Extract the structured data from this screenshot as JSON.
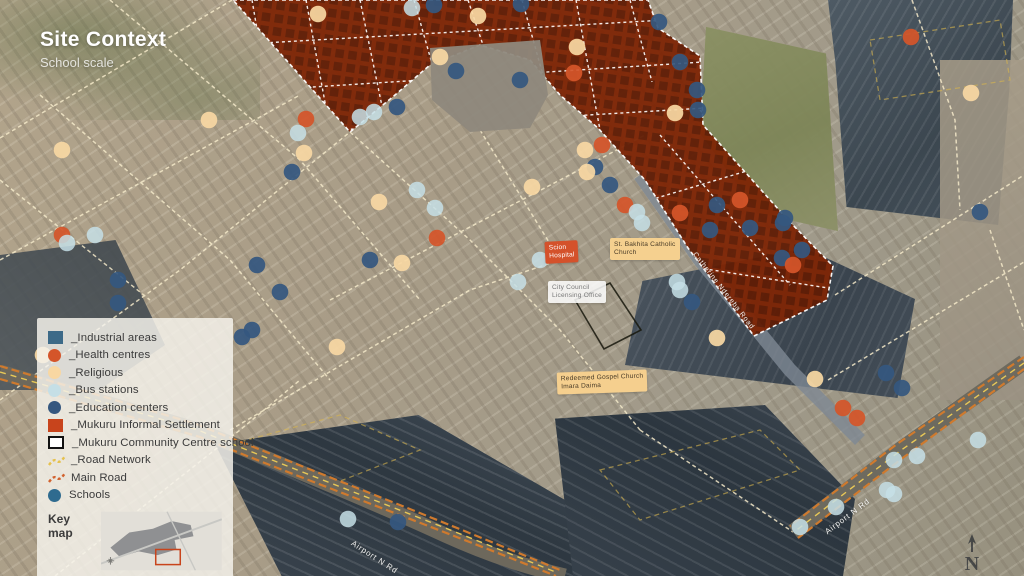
{
  "title": {
    "heading": "Site Context",
    "subheading": "School scale"
  },
  "legend": {
    "key_map_label": "Key map",
    "items": [
      {
        "label": "_Industrial areas",
        "swatch": "square",
        "color": "#3d6a88"
      },
      {
        "label": "_Health centres",
        "swatch": "circle",
        "color": "#d4552a"
      },
      {
        "label": "_Religious",
        "swatch": "circle",
        "color": "#f8d7a2"
      },
      {
        "label": "_Bus stations",
        "swatch": "circle",
        "color": "#c5dfe6"
      },
      {
        "label": "_Education centers",
        "swatch": "circle",
        "color": "#35577f"
      },
      {
        "label": "_Mukuru Informal Settlement",
        "swatch": "square",
        "color": "#c8441c"
      },
      {
        "label": "_Mukuru Community Centre school",
        "swatch": "square-outline",
        "color": "#ffffff"
      },
      {
        "label": "_Road Network",
        "swatch": "dash",
        "color": "#e6c14d"
      },
      {
        "label": "Main Road",
        "swatch": "dash",
        "color": "#d2622e"
      },
      {
        "label": "Schools",
        "swatch": "circle",
        "color": "#2f6b8f"
      }
    ]
  },
  "map": {
    "north_label": "N",
    "settlement_points": "233,0 648,0 658,28 700,56 703,125 788,220 833,266 827,300 754,336 688,248 645,180 598,128 560,95 530,60 480,45 430,65 395,95 350,132",
    "school_outline_points": "575,300 610,283 641,330 604,349",
    "marker_colors": {
      "h": "#d4552a",
      "r": "#f8d7a2",
      "b": "#c5dfe6",
      "e": "#35577f"
    },
    "labels": [
      {
        "id": "scion-hospital",
        "lines": [
          "Scion",
          "Hospital"
        ],
        "x": 545,
        "y": 241,
        "bg": "#d4512b",
        "fg": "#ffffff",
        "rot": -3
      },
      {
        "id": "st-bakhita",
        "lines": [
          "St. Bakhita Catholic",
          "Church"
        ],
        "x": 610,
        "y": 238,
        "bg": "#f5d08f",
        "fg": "#4a3c28",
        "rot": 0
      },
      {
        "id": "city-council",
        "lines": [
          "City Council",
          "Licensing Office"
        ],
        "x": 548,
        "y": 281,
        "bg": "rgba(255,255,255,0.85)",
        "fg": "#787878",
        "rot": 0
      },
      {
        "id": "redeemed-gospel",
        "lines": [
          "Redeemed Gospel Church",
          "Imara Daima"
        ],
        "x": 557,
        "y": 371,
        "bg": "#f5cf8e",
        "fg": "#4a3c28",
        "rot": -2
      }
    ],
    "road_labels": [
      {
        "text": "Catherine Ndereba Road",
        "x": 694,
        "y": 250,
        "rot": 52,
        "size": 7
      },
      {
        "text": "Airport N Rd",
        "x": 352,
        "y": 538,
        "rot": 33,
        "size": 8
      },
      {
        "text": "Airport N Rd",
        "x": 826,
        "y": 528,
        "rot": -37,
        "size": 8
      }
    ],
    "markers": [
      [
        318,
        14,
        "r"
      ],
      [
        412,
        8,
        "b"
      ],
      [
        434,
        5,
        "e"
      ],
      [
        478,
        16,
        "r"
      ],
      [
        521,
        4,
        "e"
      ],
      [
        659,
        22,
        "e"
      ],
      [
        911,
        37,
        "h"
      ],
      [
        577,
        47,
        "r"
      ],
      [
        440,
        57,
        "r"
      ],
      [
        456,
        71,
        "e"
      ],
      [
        574,
        73,
        "h"
      ],
      [
        520,
        80,
        "e"
      ],
      [
        680,
        62,
        "e"
      ],
      [
        697,
        90,
        "e"
      ],
      [
        971,
        93,
        "r"
      ],
      [
        698,
        110,
        "e"
      ],
      [
        675,
        113,
        "r"
      ],
      [
        306,
        119,
        "h"
      ],
      [
        360,
        117,
        "b"
      ],
      [
        374,
        112,
        "b"
      ],
      [
        397,
        107,
        "e"
      ],
      [
        298,
        133,
        "b"
      ],
      [
        209,
        120,
        "r"
      ],
      [
        304,
        153,
        "r"
      ],
      [
        62,
        150,
        "r"
      ],
      [
        585,
        150,
        "r"
      ],
      [
        602,
        145,
        "h"
      ],
      [
        595,
        167,
        "e"
      ],
      [
        587,
        172,
        "r"
      ],
      [
        292,
        172,
        "e"
      ],
      [
        610,
        185,
        "e"
      ],
      [
        532,
        187,
        "r"
      ],
      [
        417,
        190,
        "b"
      ],
      [
        379,
        202,
        "r"
      ],
      [
        435,
        208,
        "b"
      ],
      [
        625,
        205,
        "h"
      ],
      [
        637,
        212,
        "b"
      ],
      [
        680,
        213,
        "h"
      ],
      [
        740,
        200,
        "h"
      ],
      [
        717,
        205,
        "e"
      ],
      [
        785,
        218,
        "e"
      ],
      [
        980,
        212,
        "e"
      ],
      [
        437,
        238,
        "h"
      ],
      [
        370,
        260,
        "e"
      ],
      [
        402,
        263,
        "r"
      ],
      [
        540,
        260,
        "b"
      ],
      [
        518,
        282,
        "b"
      ],
      [
        642,
        223,
        "b"
      ],
      [
        710,
        230,
        "e"
      ],
      [
        750,
        228,
        "e"
      ],
      [
        783,
        223,
        "e"
      ],
      [
        802,
        250,
        "e"
      ],
      [
        782,
        258,
        "e"
      ],
      [
        793,
        265,
        "h"
      ],
      [
        677,
        282,
        "b"
      ],
      [
        680,
        290,
        "b"
      ],
      [
        692,
        302,
        "e"
      ],
      [
        62,
        235,
        "h"
      ],
      [
        67,
        243,
        "b"
      ],
      [
        95,
        235,
        "b"
      ],
      [
        118,
        280,
        "e"
      ],
      [
        118,
        303,
        "e"
      ],
      [
        257,
        265,
        "e"
      ],
      [
        280,
        292,
        "e"
      ],
      [
        242,
        337,
        "e"
      ],
      [
        252,
        330,
        "e"
      ],
      [
        337,
        347,
        "r"
      ],
      [
        43,
        355,
        "r"
      ],
      [
        717,
        338,
        "r"
      ],
      [
        815,
        379,
        "r"
      ],
      [
        886,
        373,
        "e"
      ],
      [
        902,
        388,
        "e"
      ],
      [
        843,
        408,
        "h"
      ],
      [
        857,
        418,
        "h"
      ],
      [
        978,
        440,
        "b"
      ],
      [
        894,
        460,
        "b"
      ],
      [
        917,
        456,
        "b"
      ],
      [
        887,
        490,
        "b"
      ],
      [
        894,
        494,
        "b"
      ],
      [
        836,
        507,
        "b"
      ],
      [
        800,
        527,
        "b"
      ],
      [
        348,
        519,
        "b"
      ],
      [
        398,
        522,
        "e"
      ]
    ]
  }
}
